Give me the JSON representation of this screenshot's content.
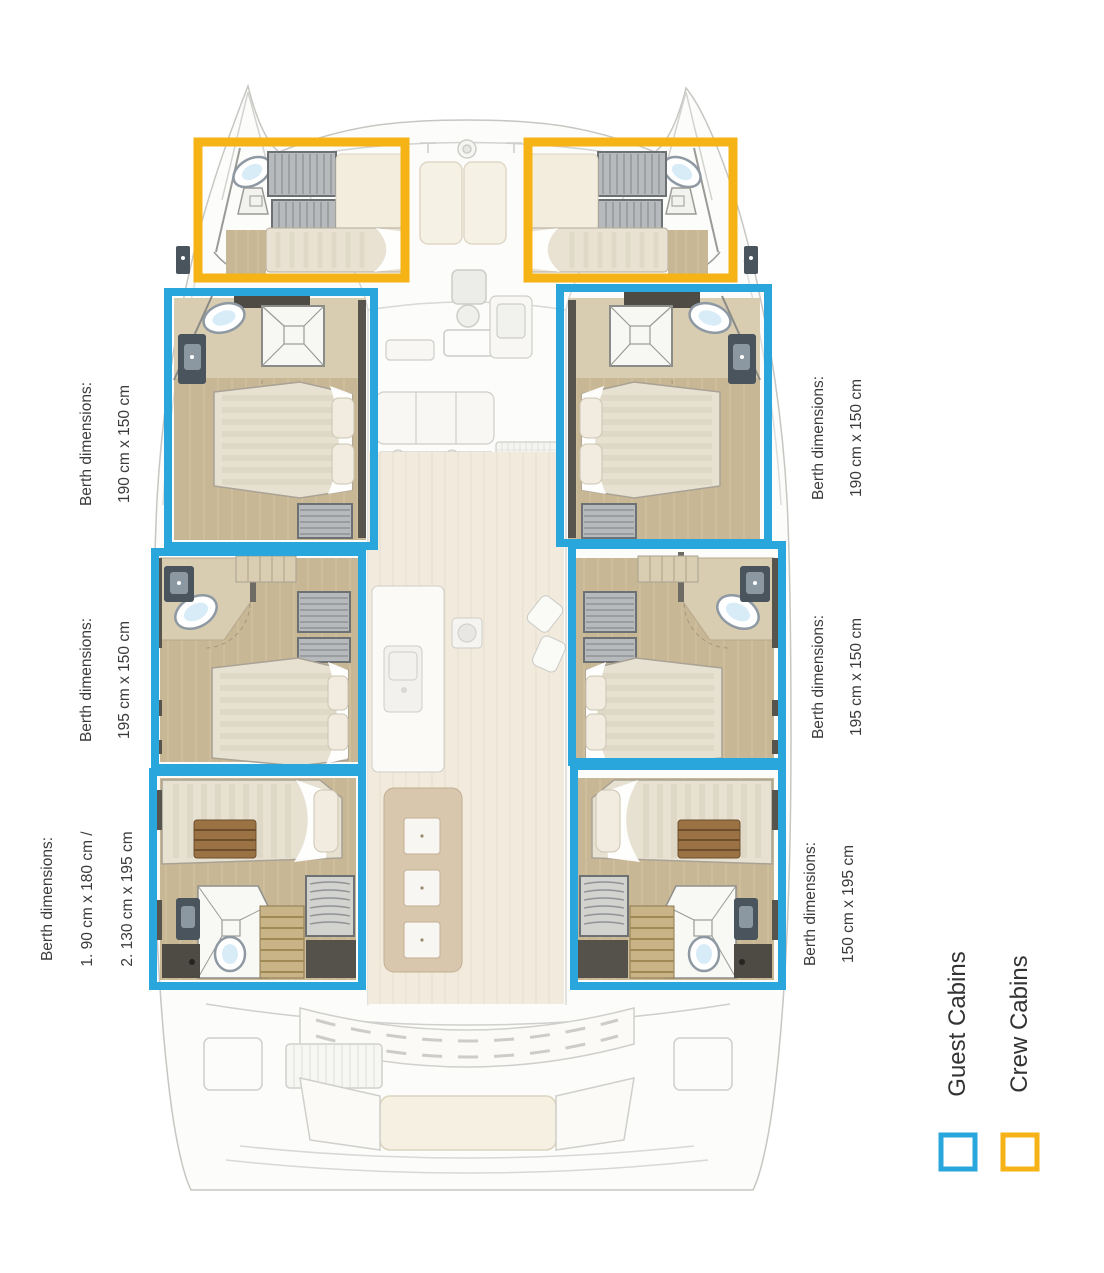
{
  "colors": {
    "guest_cabin": "#29A7DC",
    "crew_cabin": "#F5B316",
    "label_text": "#3B3B3B"
  },
  "berth_labels": {
    "left": [
      {
        "title": "Berth dimensions:",
        "lines": [
          "190 cm x 150 cm"
        ]
      },
      {
        "title": "Berth dimensions:",
        "lines": [
          "195 cm x 150 cm"
        ]
      },
      {
        "title": "Berth dimensions:",
        "lines": [
          "1. 90 cm x 180 cm /",
          "2. 130 cm x 195 cm"
        ]
      }
    ],
    "right": [
      {
        "title": "Berth dimensions:",
        "lines": [
          "190 cm x 150 cm"
        ]
      },
      {
        "title": "Berth dimensions:",
        "lines": [
          "195 cm x 150 cm"
        ]
      },
      {
        "title": "Berth dimensions:",
        "lines": [
          "150 cm x 195 cm"
        ]
      }
    ]
  },
  "legend": {
    "guest_label": "Guest Cabins",
    "crew_label": "Crew Cabins"
  }
}
